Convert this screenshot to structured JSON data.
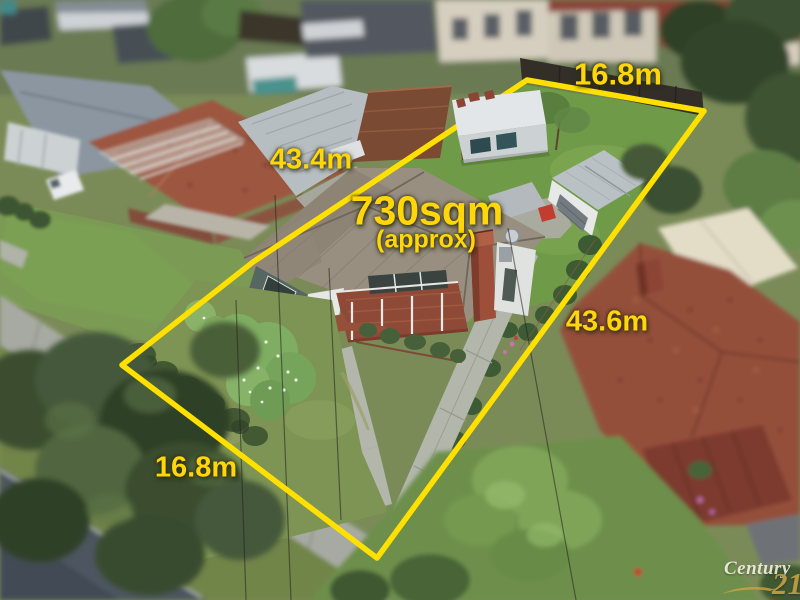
{
  "annotations": {
    "area": "730sqm",
    "area_qualifier": "(approx)",
    "top_width": "16.8m",
    "left_length": "43.4m",
    "right_length": "43.6m",
    "bottom_width": "16.8m"
  },
  "watermark": {
    "brand_name": "Century",
    "brand_number": "21"
  },
  "colors": {
    "boundary_yellow": "#FFE000",
    "label_yellow": "#FFD60A",
    "watermark_gold": "#C9A245",
    "watermark_white": "#F6F2E6"
  }
}
